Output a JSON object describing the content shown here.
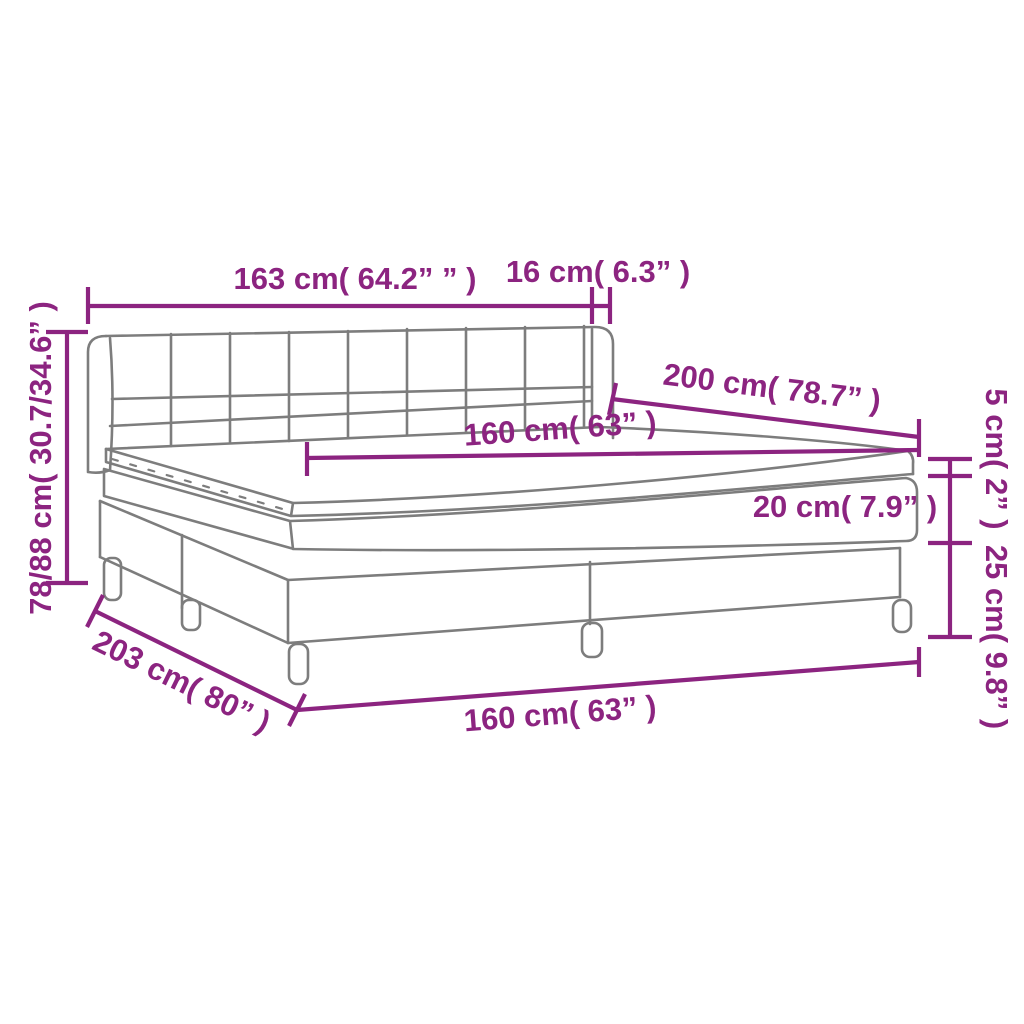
{
  "diagram": {
    "type": "product-dimension-diagram",
    "subject": "box spring bed with headboard, mattress and topper",
    "colors": {
      "dimension": "#8C2480",
      "outline": "#7D7D7D",
      "background": "#FFFFFF"
    },
    "labels": {
      "headboard_width": "163 cm( 64.2” ” )",
      "wing_depth": "16 cm( 6.3” )",
      "height_range": "78/88 cm( 30.7/34.6” )",
      "bed_length": "200 cm( 78.7” )",
      "mattress_width_top": "160 cm( 63” )",
      "topper_thickness": "5 cm( 2” )",
      "mattress_thickness": "20 cm( 7.9” )",
      "base_leg_height": "25 cm( 9.8” )",
      "total_length": "203 cm( 80” )",
      "mattress_width_bottom": "160 cm( 63” )"
    }
  }
}
